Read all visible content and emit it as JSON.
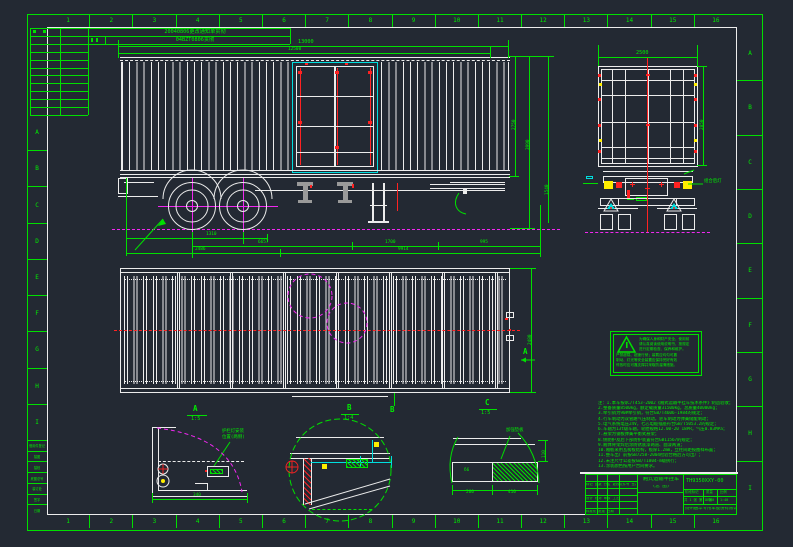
{
  "zones": {
    "cols": [
      "1",
      "2",
      "3",
      "4",
      "5",
      "6",
      "7",
      "8",
      "9",
      "10",
      "11",
      "12",
      "13",
      "14",
      "15",
      "16"
    ],
    "rows_left": [
      "A",
      "B",
      "C",
      "D",
      "E",
      "F",
      "G",
      "H",
      "I"
    ],
    "rows_right": [
      "A",
      "B",
      "C",
      "D",
      "E",
      "F",
      "G",
      "H",
      "I"
    ]
  },
  "revision_table": {
    "row1": "20040806更改通知单贯彻",
    "row2": "04BZT0806贯彻"
  },
  "mini_table": {
    "rows": [
      "借用件登记",
      "描图",
      "描校",
      "底图总号",
      "装订处",
      "签字",
      "日期"
    ]
  },
  "side_view": {
    "dims_top": [
      "13000",
      "12500"
    ],
    "dims_right": [
      "2750",
      "3990",
      "1540"
    ],
    "dims_bottom_row1": [
      "1310"
    ],
    "dims_bottom_row2": [
      "6657",
      "1700",
      "995"
    ],
    "dims_bottom_row3": [
      "2486",
      "9914"
    ]
  },
  "rear_view": {
    "dim_top": "2500",
    "dim_right": "2850",
    "lamp_label": "组合后灯"
  },
  "plan_view": {
    "dim_right": "2480",
    "section_a": "A",
    "section_b": "B"
  },
  "details": {
    "a": {
      "label": "A",
      "scale": "1:5",
      "callout_line1": "护栏灯安装",
      "callout_line2": "位置(两侧)",
      "dim": "340"
    },
    "b": {
      "label": "B",
      "scale": "1:4"
    },
    "c": {
      "label": "C",
      "scale": "1:5",
      "callout": "加强垫板",
      "cell": "δ6",
      "dims": [
        "260",
        "410"
      ],
      "dim_right": "110"
    }
  },
  "warning": {
    "lines": [
      "为确保人身和财产安全，使用前",
      "请认真阅读使用说明书，按规定",
      "进行定期检查、保养和维护。",
      "严禁超载、超速行驶；装载应均匀可靠",
      "制动、灯光等安全装置应保持完好有效",
      "停放时应可靠支撑并采取防溜滑措施。"
    ]
  },
  "notes": {
    "lines": [
      "注：1.本车按QC/T453-2002《厢式运输半挂车技术条件》制造验收；",
      "2.整备质量8500kg，额定载质量31500kg，总质量40000kg；",
      "3.牵引销为90#牵引销，符合GB/T4606-1984的规定；",
      "4.行车制动为双管路气压制动，驻车制动为弹簧储能制动；",
      "5.电气系统电压24V，七芯电缆插座符合GB/T5053.2的规定；",
      "6.车轴为13t级车轴，轮胎规格12.00-20 18PR，气压0.83MPa；",
      "7.悬架为钢板弹簧平衡式悬架；",
      "8.侧防护及后下部防护装置符合GB11567的规定；",
      "9.厢体骨架焊后涂防锈底漆两道、面漆两道；",
      "10.厢板采用瓦楞板结构，板厚1.2mm，立柱间距按图样布置；",
      "11.整车出厂前按GB7258-2004检验合格后方可出厂；",
      "12.未注尺寸公差按GB/T1804-m级执行；",
      "13.涂装颜色按用户合同要求。"
    ]
  },
  "title_block": {
    "company": "扬州通华专用车股份有限公司",
    "product_line1": "厢式运输半挂车",
    "product_line2": "(总 图)",
    "drawing_no": "TH9350XXY-00",
    "left_row1": "标记 处数 分区 更改文件号 签名",
    "left_row2": "设计 校对 审核 工艺",
    "left_row3": "标准化 批准 日期",
    "stage_label": "阶段标记",
    "mass_label": "质量",
    "scale_label": "比例",
    "mass_value": "8500",
    "scale_value": "1:40",
    "sheet_info": "共 1 张 第 1 张"
  }
}
